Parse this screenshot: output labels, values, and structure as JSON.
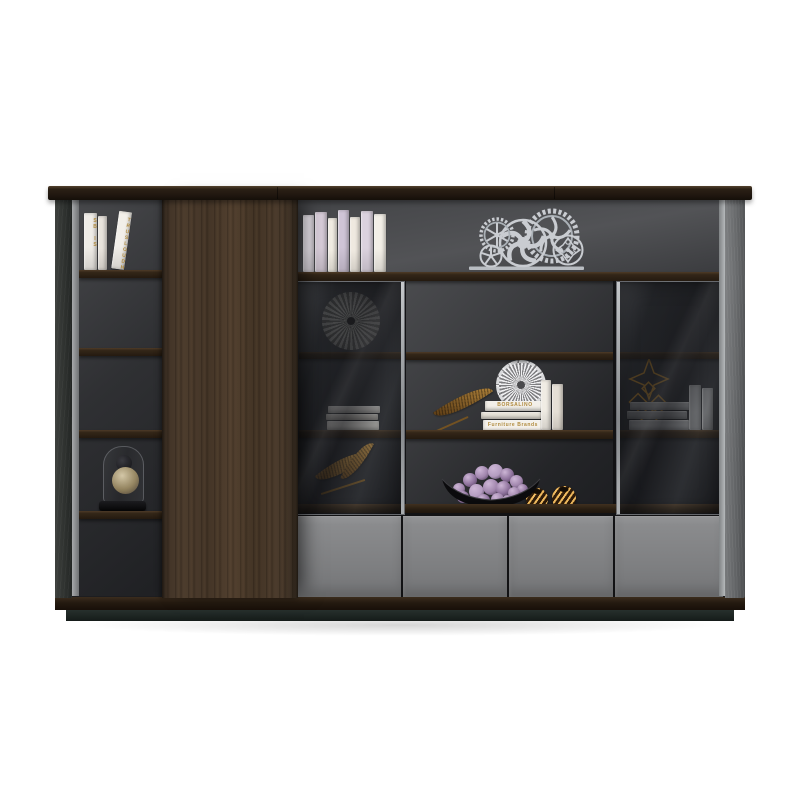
{
  "meta": {
    "image_type": "furniture product photograph",
    "subject": "Dark walnut office wall bookcase with sliding wood panel, smoked-glass display doors, open shelves and grey lower drawers, styled with books and ornaments",
    "background_color": "#ffffff"
  },
  "palette": {
    "wood_dark": "#241a10",
    "wood_door": "#4a3a2b",
    "drawer_grey": "#828385",
    "back_grey_light": "#515255",
    "back_grey_dark": "#232427",
    "glass_tint": "rgba(22,23,27,0.6)",
    "silver": "#c9ccd1",
    "gold": "#b08a3e",
    "purple_flower": "#9d81a9",
    "book_white": "#f1ede5",
    "book_lavender": "#d3c8d8"
  },
  "texts": {
    "left_spine_1": "SB IS",
    "left_spine_2": "TRUSLOUDH",
    "stack_top": "BORSALINO",
    "stack_bottom": "Furniture Brands"
  },
  "books": {
    "left_top": [
      {
        "w": 13,
        "h": 57,
        "c": "#efece7",
        "t": "SB IS"
      },
      {
        "w": 9,
        "h": 54,
        "c": "#e9e4dd",
        "t": ""
      },
      {
        "w": 13,
        "h": 58,
        "c": "#f2efe9",
        "t": "TRUSLOUDH",
        "lean": 8
      }
    ],
    "main_top": [
      {
        "w": 11,
        "h": 57,
        "c": "#ece7ee",
        "t": ""
      },
      {
        "w": 12,
        "h": 60,
        "c": "#d8cdd9",
        "t": ""
      },
      {
        "w": 9,
        "h": 54,
        "c": "#f1ece2",
        "t": ""
      },
      {
        "w": 11,
        "h": 62,
        "c": "#cfc4d6",
        "t": ""
      },
      {
        "w": 10,
        "h": 55,
        "c": "#efe9e0",
        "t": ""
      },
      {
        "w": 12,
        "h": 61,
        "c": "#dbd2de",
        "t": ""
      },
      {
        "w": 12,
        "h": 58,
        "c": "#f3efe7",
        "t": ""
      }
    ],
    "left_cab_stack": [
      {
        "h": 7,
        "c": "#dcd8d2",
        "t": "",
        "ml": 2
      },
      {
        "h": 6,
        "c": "#cfc9c0",
        "t": "",
        "ml": 0
      },
      {
        "h": 9,
        "c": "#e5e1da",
        "t": "",
        "ml": 1
      }
    ],
    "mid_stack": [
      {
        "h": 10,
        "c": "#f2efe9",
        "t": "BORSALINO",
        "ml": 4
      },
      {
        "h": 8,
        "c": "#e7e2d8",
        "t": "",
        "ml": 0
      },
      {
        "h": 12,
        "c": "#f4f1ea",
        "t": "Furniture Brands",
        "ml": 2
      }
    ],
    "mid_standing": [
      {
        "w": 10,
        "h": 50,
        "c": "#f0ece4",
        "t": ""
      },
      {
        "w": 11,
        "h": 46,
        "c": "#e5dfd5",
        "t": ""
      }
    ],
    "right_stack": [
      {
        "h": 9,
        "c": "#9b9da0",
        "t": "",
        "ml": 3
      },
      {
        "h": 8,
        "c": "#8b8d90",
        "t": "",
        "ml": 0
      },
      {
        "h": 11,
        "c": "#a4a6a9",
        "t": "",
        "ml": 2
      }
    ],
    "right_standing": [
      {
        "w": 12,
        "h": 45,
        "c": "#9a9c9f",
        "t": ""
      },
      {
        "w": 11,
        "h": 42,
        "c": "#8f9194",
        "t": ""
      }
    ]
  },
  "decor": {
    "gear_sculpture": {
      "color": "#c9ccd1",
      "gears": 5
    },
    "pleated_fan": {
      "color": "#b7b6b1"
    },
    "starburst_flower": {
      "color": "#efeff1"
    },
    "gold_leaves": 2,
    "gold_feather": 1,
    "wire_ornament": {
      "color": "#a2701f"
    },
    "bottles": 3,
    "glass_dome": {
      "sphere_color": "#ddd0ae"
    },
    "gold_spheres": 2,
    "hydrangea": {
      "bowl_color": "#0b0b0d",
      "ball_colors": [
        "#a186ad",
        "#8d719b",
        "#b49cc0"
      ],
      "balls": [
        [
          6,
          26,
          12,
          0
        ],
        [
          16,
          16,
          14,
          1
        ],
        [
          28,
          9,
          14,
          0
        ],
        [
          41,
          7,
          15,
          2
        ],
        [
          53,
          11,
          14,
          1
        ],
        [
          63,
          18,
          13,
          0
        ],
        [
          70,
          27,
          11,
          1
        ],
        [
          10,
          34,
          12,
          1
        ],
        [
          22,
          27,
          15,
          2
        ],
        [
          36,
          22,
          16,
          0
        ],
        [
          49,
          24,
          15,
          1
        ],
        [
          61,
          30,
          12,
          0
        ],
        [
          30,
          37,
          13,
          1
        ],
        [
          44,
          36,
          13,
          0
        ],
        [
          55,
          38,
          11,
          1
        ]
      ]
    }
  },
  "structure": {
    "drawer_count": 4,
    "glass_doors": 2,
    "open_left_shelves": 5
  }
}
